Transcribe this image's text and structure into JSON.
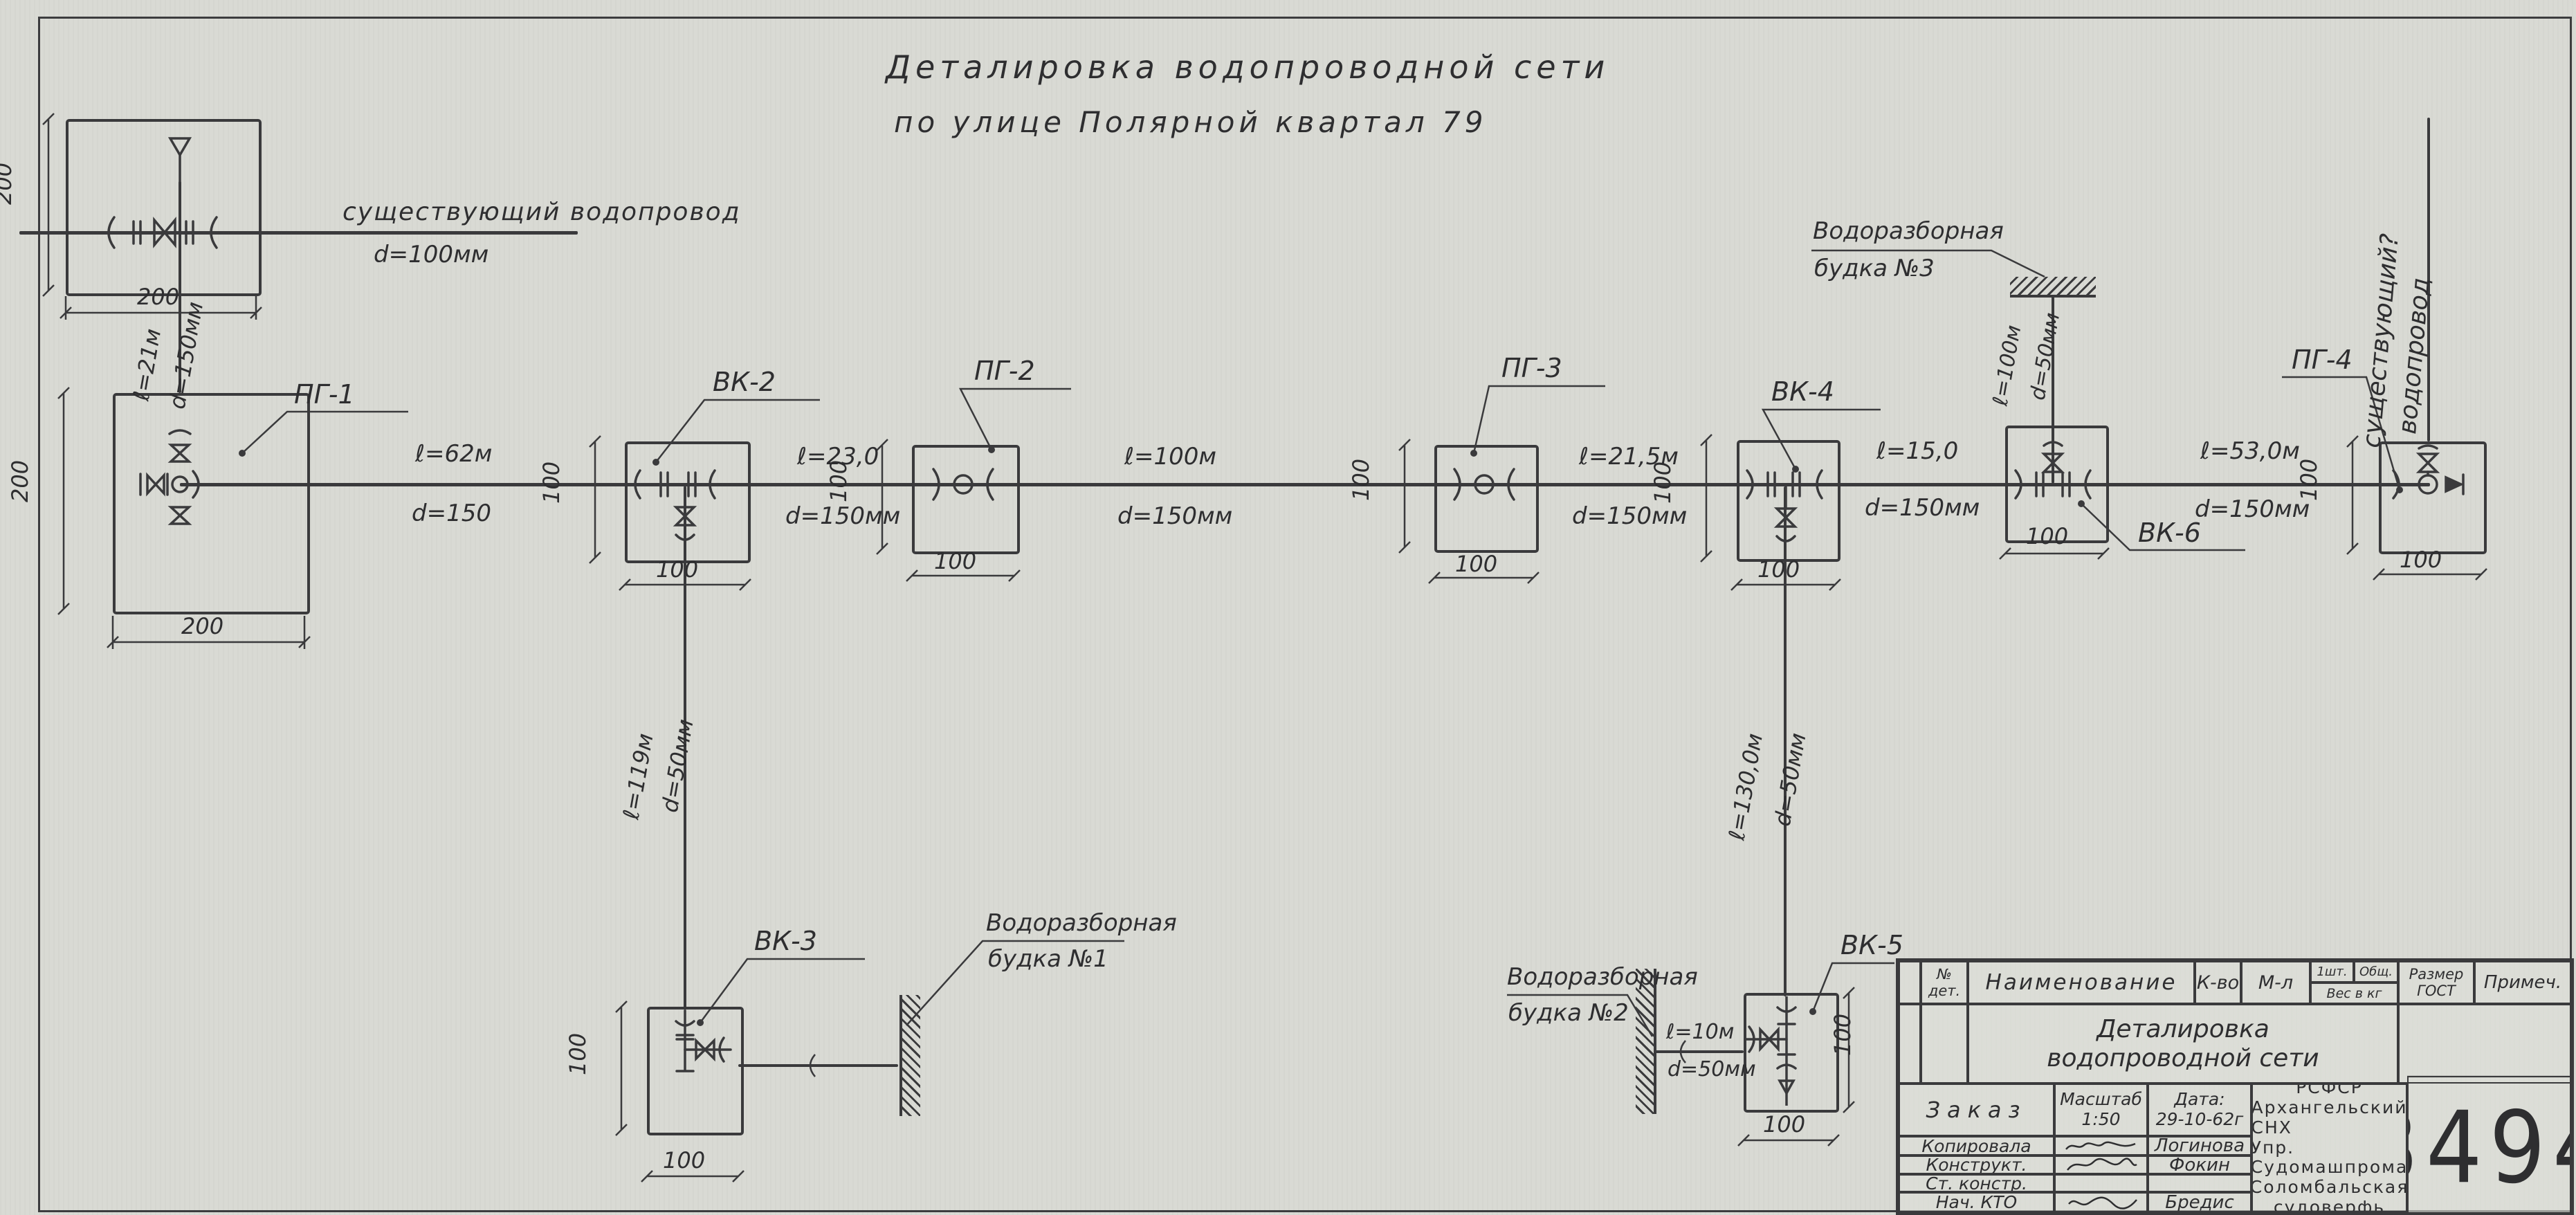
{
  "title": {
    "line1": "Деталировка  водопроводной  сети",
    "line2": "по улице  Полярной  квартал 79"
  },
  "existing_main": {
    "label": "существующий  водопровод",
    "diameter": "d=100мм"
  },
  "pg4_riser": {
    "line1": "существующий?",
    "line2": "водопровод"
  },
  "nodes": {
    "pg1": "ПГ-1",
    "vk2": "ВК-2",
    "pg2": "ПГ-2",
    "pg3": "ПГ-3",
    "vk4": "ВК-4",
    "vk6": "ВК-6",
    "pg4": "ПГ-4",
    "vk3": "ВК-3",
    "vk5": "ВК-5"
  },
  "segments": {
    "riser": {
      "len": "ℓ=21м",
      "dia": "d=150мм"
    },
    "pg1_vk2": {
      "len": "ℓ=62м",
      "dia": "d=150"
    },
    "vk2_pg2": {
      "len": "ℓ=23,0",
      "dia": "d=150мм"
    },
    "pg2_pg3": {
      "len": "ℓ=100м",
      "dia": "d=150мм"
    },
    "pg3_vk4": {
      "len": "ℓ=21,5м",
      "dia": "d=150мм"
    },
    "vk4_vk6": {
      "len": "ℓ=15,0",
      "dia": "d=150мм"
    },
    "vk6_pg4": {
      "len": "ℓ=53,0м",
      "dia": "d=150мм"
    },
    "vk2_vk3": {
      "len": "ℓ=119м",
      "dia": "d=50мм"
    },
    "vk4_vk5": {
      "len": "ℓ=130,0м",
      "dia": "d=50мм"
    },
    "vk6_booth3": {
      "len": "ℓ=100м",
      "dia": "d=50мм"
    },
    "booth2_vk5": {
      "len": "ℓ=10м",
      "dia": "d=50мм"
    }
  },
  "booths": {
    "b1": {
      "line1": "Водоразборная",
      "line2": "будка №1"
    },
    "b2": {
      "line1": "Водоразборная",
      "line2": "будка №2"
    },
    "b3": {
      "line1": "Водоразборная",
      "line2": "будка №3"
    }
  },
  "dims": {
    "d200": "200",
    "d100": "100"
  },
  "title_block": {
    "header": {
      "no": "№",
      "no2": "дет.",
      "name": "Наименование",
      "qty": "К-во",
      "mat": "М-л",
      "one": "1шт.",
      "total": "Общ.",
      "weight": "Вес в кг",
      "size1": "Размер",
      "size2": "ГОСТ",
      "note": "Примеч."
    },
    "doc_name1": "Деталировка",
    "doc_name2": "водопроводной сети",
    "order": "Заказ",
    "scale_label": "Масштаб",
    "scale_value": "1:50",
    "date_label": "Дата:",
    "date_value": "29-10-62г",
    "rows": [
      {
        "role": "Копировала",
        "name": "Логинова"
      },
      {
        "role": "Конструкт.",
        "name": "Фокин"
      },
      {
        "role": "Ст. констр.",
        "name": ""
      },
      {
        "role": "Нач. КТО",
        "name": "Бредис"
      }
    ],
    "org": [
      "РСФСР",
      "Архангельский СНХ",
      "Упр. Судомашпрома",
      "Соломбальская",
      "судоверфь"
    ],
    "number": "3494"
  }
}
